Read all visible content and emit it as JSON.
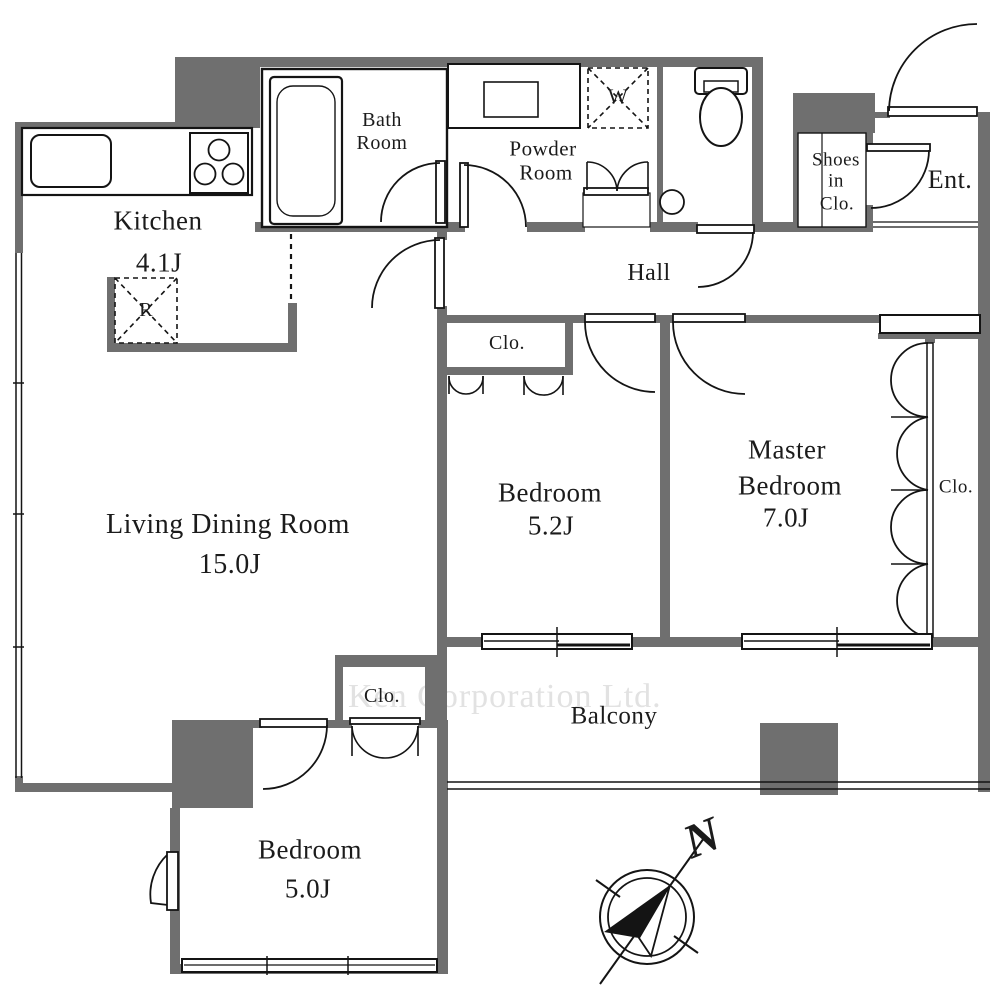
{
  "watermark": "Ken Corporation Ltd.",
  "compass": {
    "north": "N"
  },
  "rooms": {
    "kitchen": {
      "name": "Kitchen",
      "size": "4.1J"
    },
    "living": {
      "name": "Living Dining Room",
      "size": "15.0J"
    },
    "bath": {
      "name_line1": "Bath",
      "name_line2": "Room"
    },
    "powder": {
      "name_line1": "Powder",
      "name_line2": "Room"
    },
    "hall": {
      "name": "Hall"
    },
    "entrance": {
      "name": "Ent."
    },
    "shoes_closet": {
      "line1": "Shoes",
      "line2": "in",
      "line3": "Clo."
    },
    "bedroom_52": {
      "name": "Bedroom",
      "size": "5.2J"
    },
    "master_bedroom": {
      "line1": "Master",
      "line2": "Bedroom",
      "size": "7.0J"
    },
    "bedroom_50": {
      "name": "Bedroom",
      "size": "5.0J"
    },
    "balcony": {
      "name": "Balcony"
    }
  },
  "closets": {
    "bedroom_52": "Clo.",
    "master": "Clo.",
    "bedroom_50": "Clo."
  },
  "appliances": {
    "washer": "W",
    "refrigerator": "R"
  },
  "colors": {
    "wall": "#6f6f6f",
    "line": "#141414",
    "watermark": "#e2e2e2"
  }
}
